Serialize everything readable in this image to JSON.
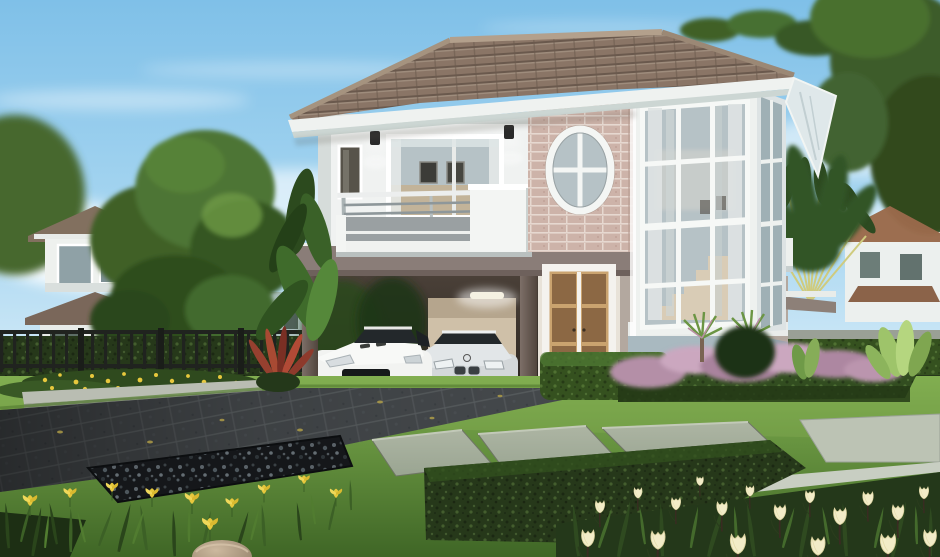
{
  "meta": {
    "description": "Photorealistic architectural rendering of a modern two-story suburban house with a hip tile roof, stone-brick accent wall with oval window, two-story corner window, balcony, carport sheltering a white sports coupe and a silver sedan, landscaped lawn with stepping stones, hedges, purple fountain grass and cream tulips, neighbouring houses and trees in the background under a blue sky",
    "scene_type": "exterior house rendering",
    "objects": [
      "sky",
      "clouds",
      "background-left-house",
      "background-middle-houses",
      "big-tree",
      "iron-fence",
      "main-house",
      "tile-roof",
      "balcony",
      "sliding-window",
      "oval-window",
      "brick-wall",
      "corner-window-tower",
      "wall-lamps",
      "carport",
      "white-sports-car",
      "silver-sedan",
      "french-door",
      "entry-steps",
      "right-hedge-wall",
      "travelers-palm",
      "background-right-house",
      "purple-fountain-grass",
      "lawn",
      "driveway",
      "gravel-bed",
      "stepping-stones",
      "boxwood-hedges",
      "yellow-flower-bed",
      "iris-plants",
      "tulip-bed",
      "rock",
      "red-cordyline",
      "banana-palm"
    ]
  },
  "palette": {
    "sky_top": "#7fc0e8",
    "sky_mid": "#a9d7f1",
    "sky_horizon": "#e0f0f9",
    "cloud_white": "#ffffff",
    "foliage_dark": "#31511f",
    "foliage_mid": "#47702f",
    "foliage_light": "#6f9a46",
    "tree_trunk": "#4a3a2c",
    "fence_iron": "#20231f",
    "bg_house_wall": "#eef1ee",
    "bg_house_wall_blue": "#a9bcba",
    "bg_house_roof_left": "#82705f",
    "bg_house_roof_right": "#9a6a4b",
    "hedge_dark": "#26381a",
    "hedge_mid": "#35511f",
    "hedge_light": "#4f7934",
    "roof_tile": "#8a7566",
    "roof_tile_shadow": "#6a594d",
    "roof_ridge": "#b3a08c",
    "fascia_white": "#eff2f0",
    "soffit_shadow": "#ccd6d3",
    "wall_white": "#f0f2f1",
    "wall_shadow": "#d6dcda",
    "brick_base": "#cdb3a9",
    "brick_mortar": "#e6d8d0",
    "band_taupe": "#8a7d78",
    "band_dark": "#6e615c",
    "column_taupe": "#6e6159",
    "carport_dark": "#2a241f",
    "carport_wall": "#cfc0a8",
    "glass_cool": "#b6c2c6",
    "glass_dark": "#9fb0b5",
    "curtain_gray": "#dfe3e3",
    "interior_warm": "#c3b193",
    "door_warm": "#8c6844",
    "frame_white": "#f6f8f6",
    "rail_gray": "#8e979a",
    "balcony_panel_gray": "#9aa0a2",
    "tower_base_blue": "#a9b9c0",
    "stone_slab": "#9aa592",
    "stone_pale": "#bcc3b4",
    "curb_gray": "#b9bdb2",
    "driveway_base": "#45494c",
    "driveway_joint": "#5a5f62",
    "gravel_dark": "#15171a",
    "lawn_light": "#7fae4f",
    "lawn_dark": "#3f6626",
    "flower_yellow": "#e7c83d",
    "purple_grass": "#b48fa7",
    "purple_grass_light": "#cba7bf",
    "tulip_cream": "#f2ecc8",
    "tulip_leaf": "#24381a",
    "red_plant": "#96402f",
    "palm_green": "#2d4a21",
    "palm_stem_yellow": "#cfcb7e",
    "car_white": "#f2f3f1",
    "car_silver": "#d4d8da",
    "car_glass": "#23282b",
    "wheel_dark": "#17191b",
    "rock_tan": "#b9a48c",
    "step_beige": "#d8d2c4"
  }
}
